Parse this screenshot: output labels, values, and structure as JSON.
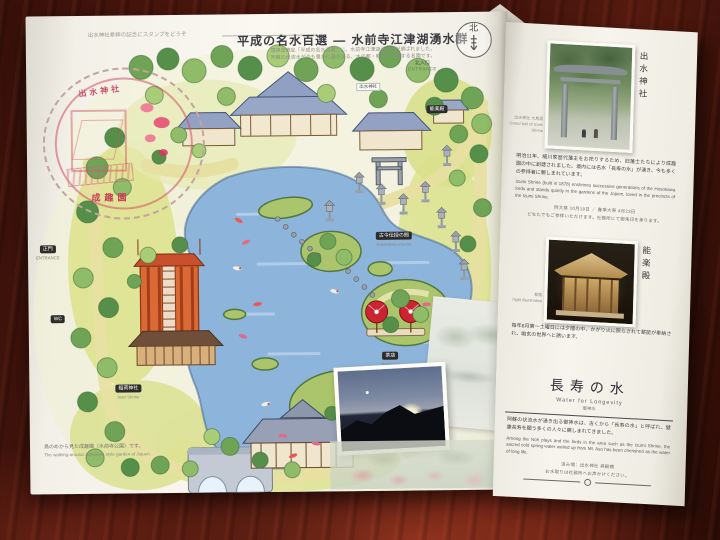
{
  "colors": {
    "stamp_red": "#cf4d66",
    "pond_blue": "#8db4da",
    "roof_blue": "#97a6c4",
    "torii_orange": "#d96a33",
    "parasol_red": "#cc2430"
  },
  "brochure": {
    "title": "平成の名水百選 ― 水前寺江津湖湧水群",
    "subtitle_line1": "環境省選定「平成の名水百選」に、水前寺江津湖湧水群が選ばれました。",
    "subtitle_line2": "阿蘇の伏流水が今も豊かに湧き出る、水の都・熊本を代表する名園です。",
    "compass_label": "北",
    "stamp_note": "出水神社参拝の記念にスタンプをどうぞ",
    "stamp_top": "出水神社",
    "stamp_bottom": "成趣園",
    "map_caption_jp": "鳥のめから見た成趣園（水前寺公園）です。",
    "map_caption_en": "The walking-around Japanese style garden of Jojuen."
  },
  "map_labels": {
    "north_entrance_jp": "北入口",
    "north_entrance_en": "ENTRANCE",
    "main_gate_jp": "正門",
    "main_gate_en": "ENTRANCE",
    "wc": "WC",
    "izumi_shrine_jp": "出水神社",
    "noh_jp": "能楽殿",
    "inari_shrine_jp": "稲荷神社",
    "inari_shrine_en": "Inari Shrine",
    "kokindenju_jp": "古今伝授の間",
    "kokindenju_en": "Kokindenju-no-ma",
    "teahouse_jp": "茶店",
    "teahouse_en": "Teahouse"
  },
  "right_page": {
    "photo1_title_vertical": "出水神社",
    "photo1_caption1": "出水神社 大鳥居",
    "photo1_caption2": "Grand torii of Izumi Shrine",
    "para1_jp": "明治11年、細川家歴代藩主をお祀りするため、旧藩士たちにより成趣園の中に創建されました。境内には名水「長寿の水」が湧き、今も多くの参拝者に親しまれています。",
    "para1_en": "Izumi Shrine (built in 1878) enshrines successive generations of the Hosokawa lords and stands quietly in the gardens of the Jojuen, loved in the precincts of the Izumi Shrine.",
    "para1_note1": "例大祭 10月18日 ／ 春季大祭 4月23日",
    "para1_note2": "どなたでもご参拝いただけます。社務所にて御朱印を承ります。",
    "photo2_title_vertical": "能楽殿",
    "photo2_caption1": "薪能",
    "photo2_caption2": "night illumination",
    "para2_jp": "毎年8月第一土曜日には夕闇の中、かがり火に照らされて薪能が奉納され、幽玄の世界へと誘います。",
    "heading_jp": "長寿の水",
    "heading_en": "Water for Longevity",
    "heading_note": "御神水",
    "para3_jp": "阿蘇の伏流水が湧き出る御神水は、古くから「長寿の水」と呼ばれ、健康長寿を願う多くの人々に親しまれてきました。",
    "para3_en": "Among the Noh plays and the birds in the area such as the Izumi Shrine, the sacred cold spring water welled up from Mt. Aso has been cherished as the water of long life.",
    "para3_note1": "汲み場：出水神社 拝殿横",
    "para3_note2": "お水取りは社務所へお声かけください。"
  }
}
